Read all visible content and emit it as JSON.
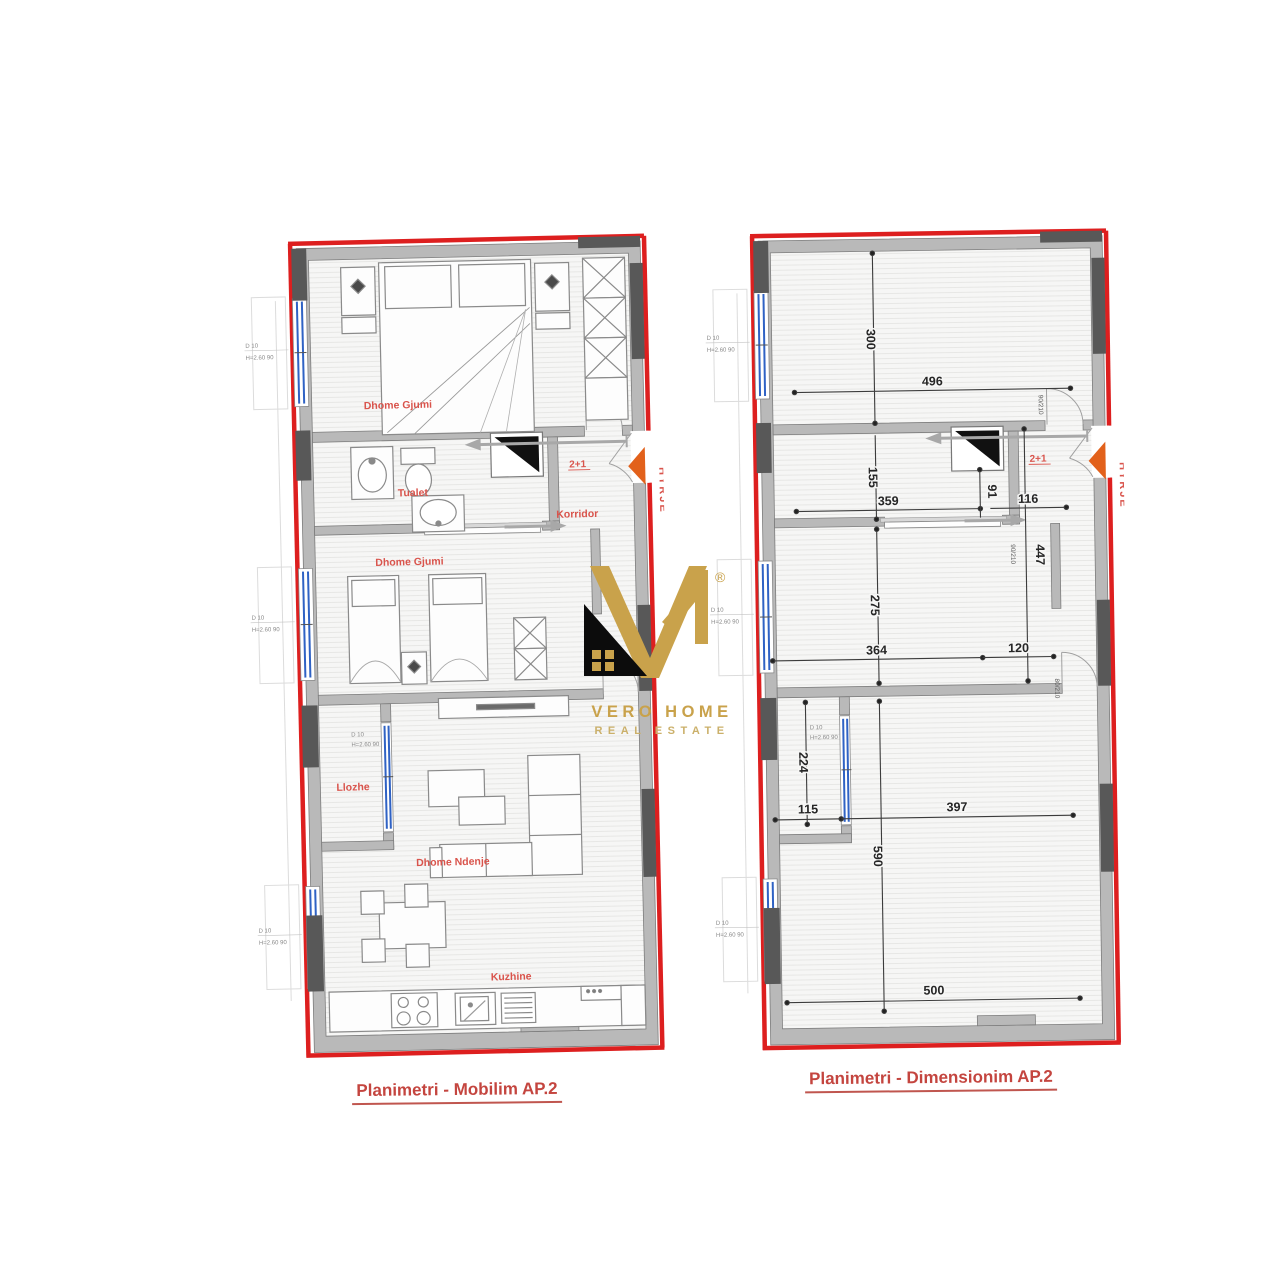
{
  "unit_type": "2+1",
  "entry": "HYRJE",
  "window_tags": {
    "top": "D      10",
    "bottom": "H=2.60   90"
  },
  "plans": {
    "left": {
      "caption": "Planimetri - Mobilim AP.2",
      "rooms": {
        "bedroom1": "Dhome Gjumi",
        "toilet": "Tualet",
        "corridor": "Korridor",
        "bedroom2": "Dhome Gjumi",
        "loggia": "Llozhe",
        "living": "Dhome Ndenje",
        "kitchen": "Kuzhine"
      }
    },
    "right": {
      "caption": "Planimetri - Dimensionim AP.2",
      "dimensions": {
        "v300": "300",
        "h496": "496",
        "v155": "155",
        "h359": "359",
        "v91": "91",
        "h116": "116",
        "v447": "447",
        "v275": "275",
        "h364": "364",
        "h120": "120",
        "v224": "224",
        "h115": "115",
        "h397": "397",
        "v590": "590",
        "h500": "500"
      },
      "door_tags": {
        "entry": "90/210",
        "mid": "90/210",
        "lower": "80/210"
      }
    }
  },
  "logo": {
    "registered": "®",
    "line1": "VERO HOME",
    "line2": "REAL ESTATE",
    "gold": "#c9a24b",
    "dark": "#0c0c0c"
  },
  "colors": {
    "outline_red": "#dd1f1f",
    "wall_gray": "#b9b9b9",
    "dark_block": "#585858",
    "window_blue": "#2f62c4",
    "label_red": "#d9544c",
    "dim_dark": "#3c3c3c",
    "entry_orange": "#e2611b"
  }
}
